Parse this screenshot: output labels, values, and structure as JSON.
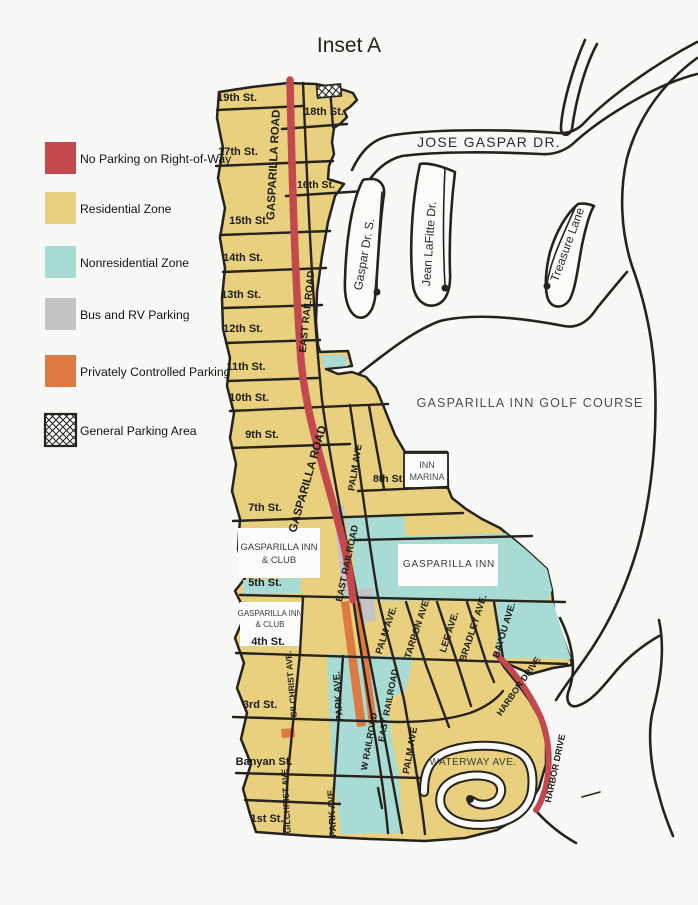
{
  "title": "Inset A",
  "colors": {
    "page": "#f8f8f6",
    "land": "#fbfbfa",
    "outline": "#26221e",
    "residential": "#e8d07e",
    "nonresidential": "#a7dbd3",
    "no_parking": "#c4494f",
    "private": "#dc7a41",
    "bus_rv": "#c4c3c6",
    "label": "#1d1d1b",
    "place_label": "#4a4a48"
  },
  "legend": {
    "items": [
      {
        "id": "no-parking",
        "label": "No Parking on Right-of-Way",
        "color": "#c4494f",
        "hatch": false
      },
      {
        "id": "residential",
        "label": "Residential Zone",
        "color": "#e8d07e",
        "hatch": false
      },
      {
        "id": "nonresidential",
        "label": "Nonresidential Zone",
        "color": "#a7dbd3",
        "hatch": false
      },
      {
        "id": "bus-rv",
        "label": "Bus and RV Parking",
        "color": "#c4c3c6",
        "hatch": false
      },
      {
        "id": "private",
        "label": "Privately Controlled Parking",
        "color": "#dc7a41",
        "hatch": false
      },
      {
        "id": "general",
        "label": "General Parking Area",
        "color": "#ffffff",
        "hatch": true
      }
    ]
  },
  "map": {
    "labels": [
      {
        "name": "street-label-19th",
        "text": "19th St.",
        "x": 237,
        "y": 101,
        "size": 11,
        "bold": true
      },
      {
        "name": "street-label-18th",
        "text": "18th St.",
        "x": 324,
        "y": 115,
        "size": 11,
        "bold": true
      },
      {
        "name": "street-label-17th",
        "text": "17th St.",
        "x": 238,
        "y": 155,
        "size": 11,
        "bold": true
      },
      {
        "name": "street-label-16th",
        "text": "16th St.",
        "x": 316,
        "y": 188,
        "size": 10.5,
        "bold": true
      },
      {
        "name": "street-label-15th",
        "text": "15th St.",
        "x": 249,
        "y": 224,
        "size": 11,
        "bold": true
      },
      {
        "name": "street-label-14th",
        "text": "14th St.",
        "x": 243,
        "y": 261,
        "size": 11,
        "bold": true
      },
      {
        "name": "street-label-13th",
        "text": "13th St.",
        "x": 241,
        "y": 298,
        "size": 11,
        "bold": true
      },
      {
        "name": "street-label-12th",
        "text": "12th St.",
        "x": 243,
        "y": 332,
        "size": 11,
        "bold": true
      },
      {
        "name": "street-label-11th",
        "text": "11th St.",
        "x": 246,
        "y": 370,
        "size": 11,
        "bold": true
      },
      {
        "name": "street-label-10th",
        "text": "10th St.",
        "x": 249,
        "y": 401,
        "size": 11,
        "bold": true
      },
      {
        "name": "street-label-9th",
        "text": "9th St.",
        "x": 262,
        "y": 438,
        "size": 11,
        "bold": true
      },
      {
        "name": "street-label-8th",
        "text": "8th St.",
        "x": 389,
        "y": 482,
        "size": 10.5,
        "bold": true
      },
      {
        "name": "street-label-7th",
        "text": "7th St.",
        "x": 265,
        "y": 511,
        "size": 11,
        "bold": true
      },
      {
        "name": "street-label-5th",
        "text": "5th St.",
        "x": 265,
        "y": 586,
        "size": 11,
        "bold": true
      },
      {
        "name": "street-label-4th",
        "text": "4th St.",
        "x": 268,
        "y": 645,
        "size": 11,
        "bold": true
      },
      {
        "name": "street-label-3rd",
        "text": "3rd St.",
        "x": 260,
        "y": 708,
        "size": 11,
        "bold": true
      },
      {
        "name": "street-label-banyan",
        "text": "Banyan St.",
        "x": 264,
        "y": 765,
        "size": 11,
        "bold": true
      },
      {
        "name": "street-label-1st",
        "text": "1st St.",
        "x": 267,
        "y": 822,
        "size": 11,
        "bold": true
      },
      {
        "name": "road-label-gasparilla-road-north",
        "text": "GASPARILLA ROAD",
        "x": 277,
        "y": 165,
        "rot": -87,
        "size": 11.5,
        "bold": true
      },
      {
        "name": "road-label-east-railroad-north",
        "text": "EAST RAILROAD",
        "x": 310,
        "y": 312,
        "rot": -84,
        "size": 10,
        "bold": true
      },
      {
        "name": "road-label-gasparilla-road-mid",
        "text": "GASPARILLA ROAD",
        "x": 311,
        "y": 480,
        "rot": -74,
        "size": 11.5,
        "bold": true
      },
      {
        "name": "road-label-palm-ave-north",
        "text": "PALM AVE",
        "x": 358,
        "y": 468,
        "rot": -81,
        "size": 9.5,
        "bold": true
      },
      {
        "name": "road-label-east-railroad-mid",
        "text": "EAST RAILROAD",
        "x": 350,
        "y": 564,
        "rot": -78,
        "size": 9.5,
        "bold": true
      },
      {
        "name": "road-label-palm-ave-mid",
        "text": "PALM AVE.",
        "x": 389,
        "y": 631,
        "rot": -72,
        "size": 9.5,
        "bold": true
      },
      {
        "name": "road-label-tarpon-ave",
        "text": "TARPON AVE.",
        "x": 420,
        "y": 629,
        "rot": -72,
        "size": 9.5,
        "bold": true
      },
      {
        "name": "road-label-lee-ave",
        "text": "LEE AVE.",
        "x": 452,
        "y": 633,
        "rot": -72,
        "size": 9.5,
        "bold": true
      },
      {
        "name": "road-label-bradley-ave",
        "text": "BRADLEY AVE.",
        "x": 476,
        "y": 629,
        "rot": -72,
        "size": 9.5,
        "bold": true
      },
      {
        "name": "road-label-bayou-ave",
        "text": "BAYOU AVE.",
        "x": 507,
        "y": 631,
        "rot": -73,
        "size": 9.5,
        "bold": true
      },
      {
        "name": "road-label-harbor-drive-north",
        "text": "HARBOR DRIVE",
        "x": 521,
        "y": 688,
        "rot": -55,
        "size": 9,
        "bold": true
      },
      {
        "name": "road-label-harbor-drive-south",
        "text": "HARBOR DRIVE",
        "x": 558,
        "y": 769,
        "rot": -78,
        "size": 9,
        "bold": true
      },
      {
        "name": "road-label-gilchrist-ave-north",
        "text": "GILCHRIST AVE.",
        "x": 294,
        "y": 684,
        "rot": -95,
        "size": 8.5,
        "bold": true
      },
      {
        "name": "road-label-park-ave-north",
        "text": "PARK AVE.",
        "x": 341,
        "y": 696,
        "rot": -94,
        "size": 9.5,
        "bold": true
      },
      {
        "name": "road-label-east-railroad-south",
        "text": "EAST RAILROAD",
        "x": 391,
        "y": 706,
        "rot": -79,
        "size": 9,
        "bold": true
      },
      {
        "name": "road-label-w-railroad",
        "text": "W RAILROAD",
        "x": 372,
        "y": 742,
        "rot": -80,
        "size": 9,
        "bold": true
      },
      {
        "name": "road-label-palm-ave-south",
        "text": "PALM AVE",
        "x": 413,
        "y": 751,
        "rot": -80,
        "size": 9.5,
        "bold": true
      },
      {
        "name": "road-label-gilchrist-ave-south",
        "text": "GILCHRIST AVE",
        "x": 289,
        "y": 801,
        "rot": -93,
        "size": 8.5,
        "bold": true
      },
      {
        "name": "road-label-park-ave-south",
        "text": "PARK AVE.",
        "x": 335,
        "y": 812,
        "rot": -93,
        "size": 9.5,
        "bold": true
      },
      {
        "name": "road-label-gaspar-dr-s",
        "text": "Gaspar Dr. S.",
        "x": 368,
        "y": 255,
        "rot": -80,
        "size": 12,
        "bold": false,
        "color": "#2b2b29"
      },
      {
        "name": "road-label-jean-lafitte-dr",
        "text": "Jean LaFitte Dr.",
        "x": 433,
        "y": 244,
        "rot": -86,
        "size": 12,
        "bold": false,
        "color": "#2b2b29"
      },
      {
        "name": "road-label-treasure-lane",
        "text": "Treasure Lane",
        "x": 571,
        "y": 246,
        "rot": -70,
        "size": 12,
        "bold": false,
        "color": "#2b2b29"
      },
      {
        "name": "road-label-jose-gaspar-dr",
        "text": "JOSE GASPAR DR.",
        "x": 489,
        "y": 147,
        "size": 14,
        "bold": false,
        "spacing": 1.2,
        "color": "#2b2b29"
      },
      {
        "name": "place-label-golf-course",
        "text": "GASPARILLA INN GOLF COURSE",
        "x": 530,
        "y": 407,
        "size": 12.5,
        "bold": false,
        "spacing": 1.2,
        "color": "#4c4c4a"
      },
      {
        "name": "place-label-inn-marina-1",
        "text": "INN",
        "x": 427,
        "y": 468,
        "size": 9,
        "bold": false,
        "color": "#4c4c4a"
      },
      {
        "name": "place-label-inn-marina-2",
        "text": "MARINA",
        "x": 427,
        "y": 480,
        "size": 9,
        "bold": false,
        "color": "#4c4c4a"
      },
      {
        "name": "place-label-gasparilla-inn",
        "text": "GASPARILLA INN",
        "x": 449,
        "y": 567,
        "size": 10,
        "bold": false,
        "spacing": 0.8,
        "color": "#3c3c3a"
      },
      {
        "name": "place-label-inn-club-upper-1",
        "text": "GASPARILLA INN",
        "x": 279,
        "y": 550,
        "size": 9.5,
        "bold": false,
        "color": "#3c3c3a"
      },
      {
        "name": "place-label-inn-club-upper-2",
        "text": "& CLUB",
        "x": 279,
        "y": 563,
        "size": 9.5,
        "bold": false,
        "color": "#3c3c3a"
      },
      {
        "name": "place-label-inn-club-lower-1",
        "text": "GASPARILLA INN",
        "x": 270,
        "y": 616,
        "size": 8,
        "bold": false,
        "color": "#3c3c3a"
      },
      {
        "name": "place-label-inn-club-lower-2",
        "text": "& CLUB",
        "x": 270,
        "y": 627,
        "size": 8,
        "bold": false,
        "color": "#3c3c3a"
      },
      {
        "name": "road-label-waterway-ave",
        "text": "WATERWAY AVE.",
        "x": 473,
        "y": 765,
        "size": 10,
        "bold": false,
        "spacing": 0.5,
        "color": "#3c3c3a"
      }
    ]
  }
}
